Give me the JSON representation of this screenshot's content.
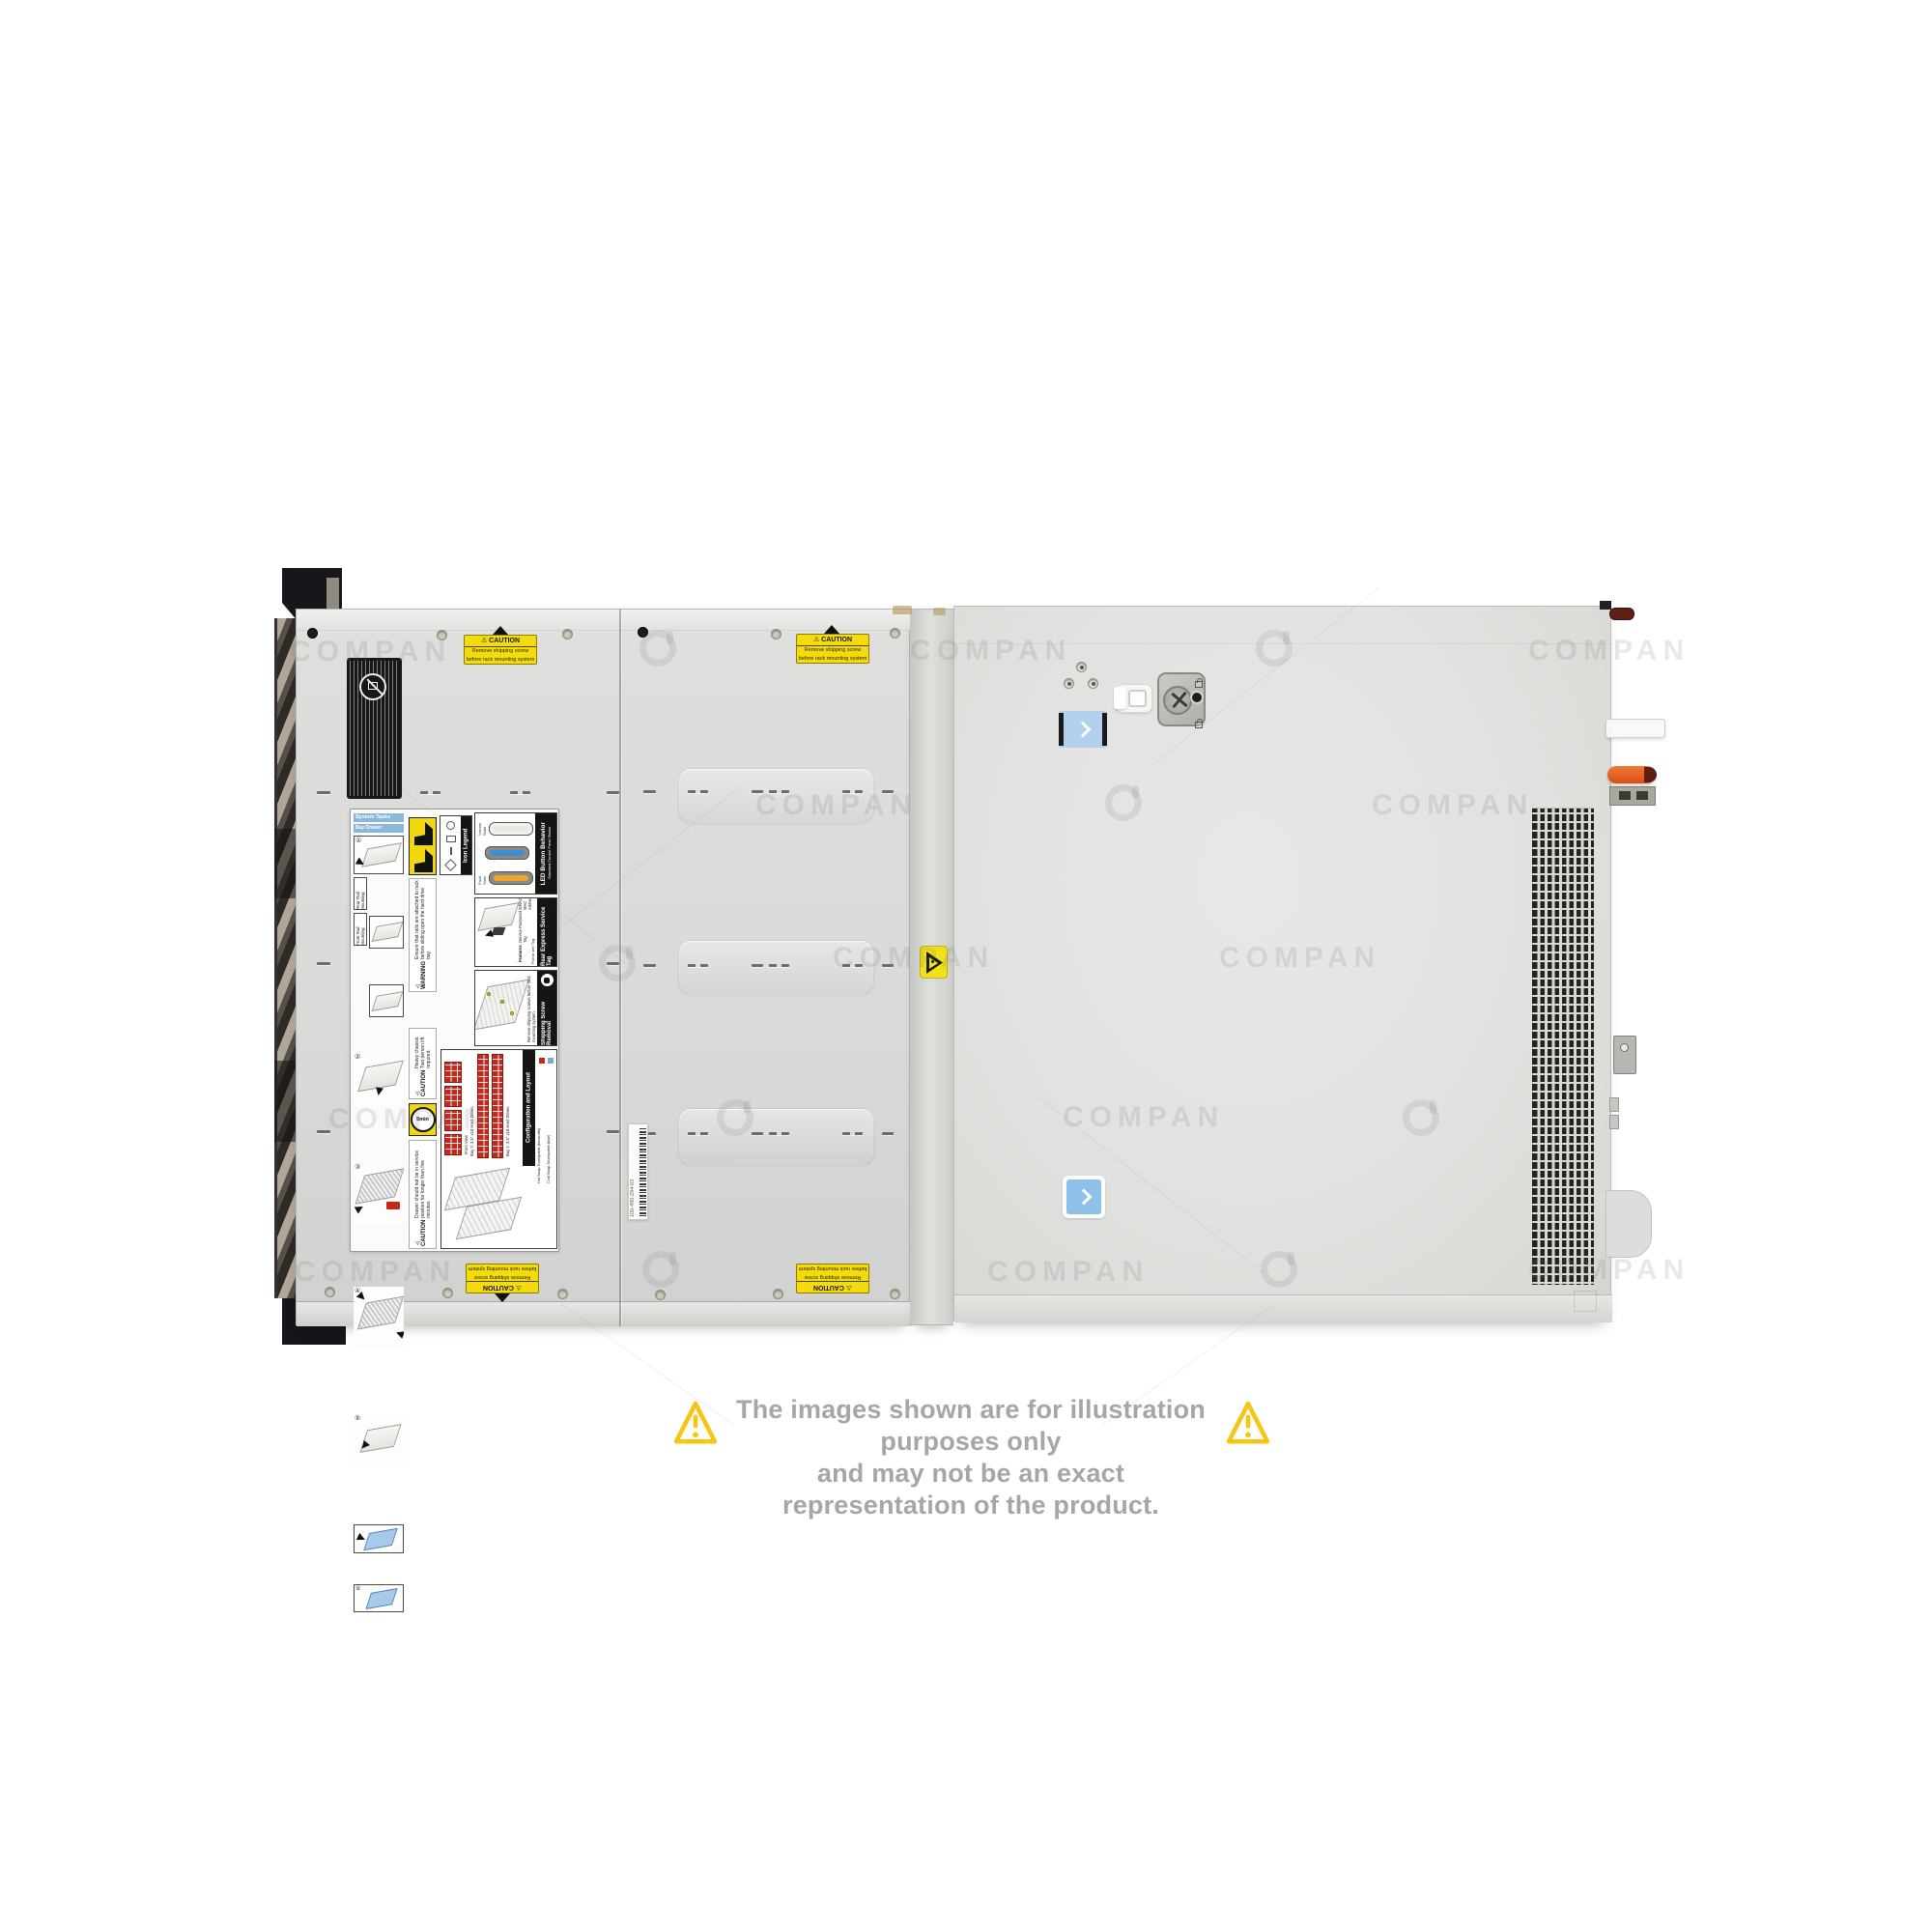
{
  "watermark": {
    "text": "COMPAN"
  },
  "glyphs": {
    "warning": "⚠",
    "steps": [
      "①",
      "②",
      "③",
      "④",
      "⑤",
      "⑥"
    ]
  },
  "disclaimer": {
    "line1": "The images shown are for illustration purposes only",
    "line2": "and may not be an exact representation of the product."
  },
  "stickers": {
    "caution": {
      "title": "CAUTION",
      "line1": "Remove shipping screw",
      "line2": "before rack mounting system"
    }
  },
  "barcode": {
    "number": "100-490-294-03"
  },
  "label": {
    "system_tasks": "System Tasks",
    "bay_drawer_operation": "Bay Drawer Operation",
    "rear_rail_mounting": "Rear Rail Mounting",
    "front_rail_mounting": "Front Rail Mounting",
    "icon_legend": "Icon Legend",
    "led_button_behavior": "LED Button Behavior",
    "led_subtitle": "Standard Control Panel Status",
    "normal_state": "Normal State",
    "fault_state": "Fault State",
    "rear_express_service_tag": "Rear Express Service Tag",
    "features_title": "Features:",
    "feature_service_tag": "Service Tag",
    "feature_password": "Password",
    "feature_idrac": "iDRAC MAC Address",
    "feature_express": "Express Service Code",
    "pull_to_see_tag": "Pull to see Tag",
    "warning_title": "WARNING",
    "warning_text": "Ensure that rails are attached to rack before sliding open the hard drive bay.",
    "shipping_screw_removal": "Shipping Screw Removal",
    "shipping_screw_text": "Remove shipping screws before rack mounting system.",
    "caution_title": "CAUTION",
    "caution_heavy_text": "Heavy chassis. Two person lift required.",
    "five_min": "5min",
    "caution_drawer_text": "Drawer should not be in service position for longer than five minutes.",
    "configuration_and_layout": "Configuration and Layout",
    "front_view": "Front View",
    "bay1": "Bay 1: 3.5\" x18 Hard Drives",
    "bay2": "Bay 2: 3.5\" x18 Hard Drives",
    "hot_swap": "Hot Swap Touchpoints (terracotta)",
    "cold_swap": "Cold Swap Touchpoints (blue)"
  }
}
